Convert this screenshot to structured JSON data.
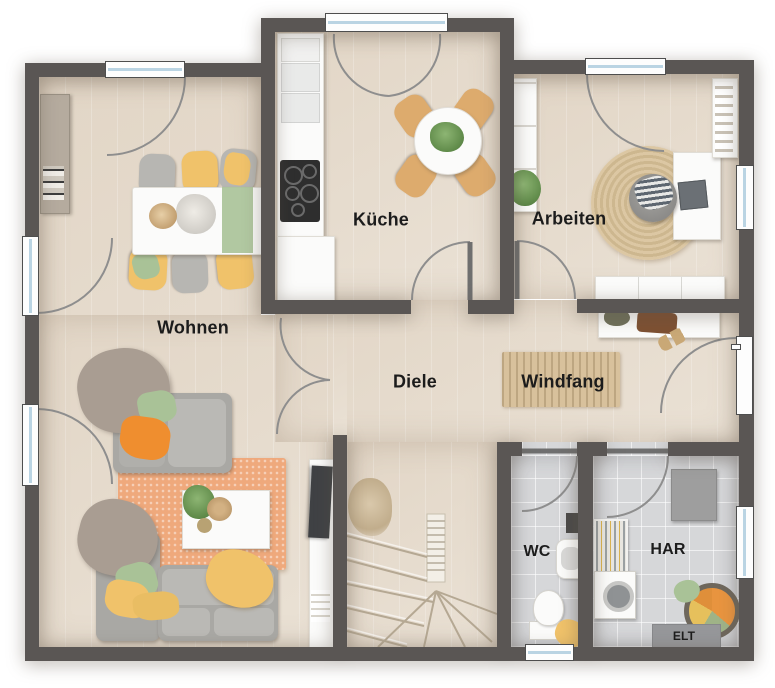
{
  "labels": {
    "wohnen": "Wohnen",
    "kueche": "Küche",
    "arbeiten": "Arbeiten",
    "diele": "Diele",
    "windfang": "Windfang",
    "wc": "WC",
    "har": "HAR",
    "elt": "ELT"
  },
  "colors": {
    "wall": "#5a5654",
    "wood": "#e7ddcf",
    "tile": "#d6d7d9",
    "white": "#fbfbfa",
    "glass": "#bad4e3",
    "arc": "#8e8e8e",
    "leaf": "#6f6f6f",
    "tread": "#b5a893",
    "label": "#1c1c1c",
    "sofa": "#a9a8a4",
    "sofaLight": "#bab9b5",
    "rug": "#efa97c",
    "yellow": "#f0c26a",
    "green": "#a9c297",
    "orange": "#ef8e2f",
    "taupe": "#a99d92",
    "jute": "#d8c19c",
    "woodChair": "#ddab6d",
    "grayChair": "#b7b6b2",
    "cabinet": "#9e9e9e",
    "sideboard": "#b5ab9e",
    "hob": "#2e2e2e",
    "tv": "#3f4144",
    "basketRim": "#6e675c"
  }
}
